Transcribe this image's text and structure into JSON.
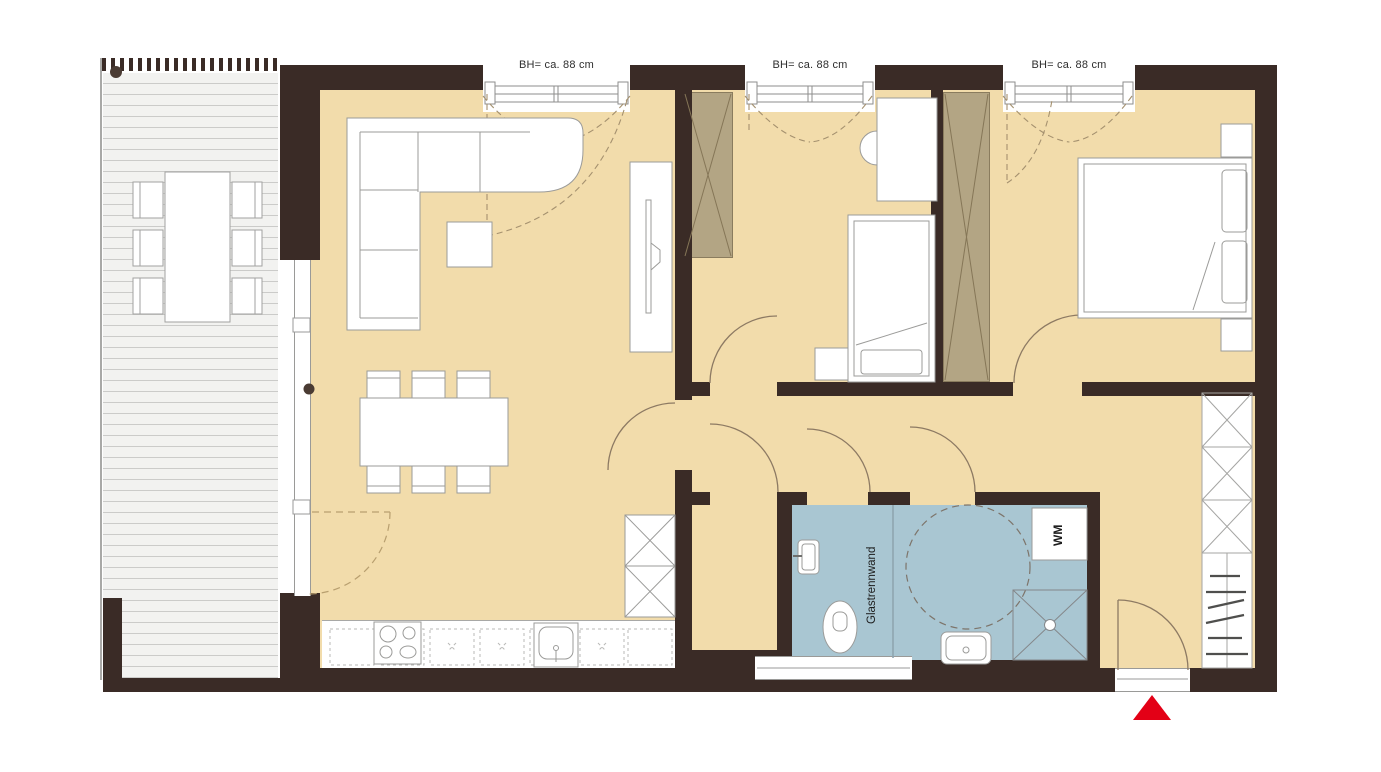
{
  "floorplan": {
    "title": "apartment-floor-plan",
    "windows": [
      {
        "label": "BH= ca. 88 cm"
      },
      {
        "label": "BH= ca. 88 cm"
      },
      {
        "label": "BH= ca. 88 cm"
      }
    ],
    "bathroom": {
      "glass_partition_label": "Glastrennwand",
      "washing_machine_label": "WM"
    },
    "icons": {
      "entrance_marker_icon": "red-triangle"
    },
    "colors": {
      "wall": "#3a2b26",
      "floor": "#f2dcab",
      "bathroom_floor": "#a9c6d2",
      "wardrobe": "#b3a584",
      "deck_line": "#cbcbc9",
      "entrance_marker": "#e30016"
    }
  }
}
